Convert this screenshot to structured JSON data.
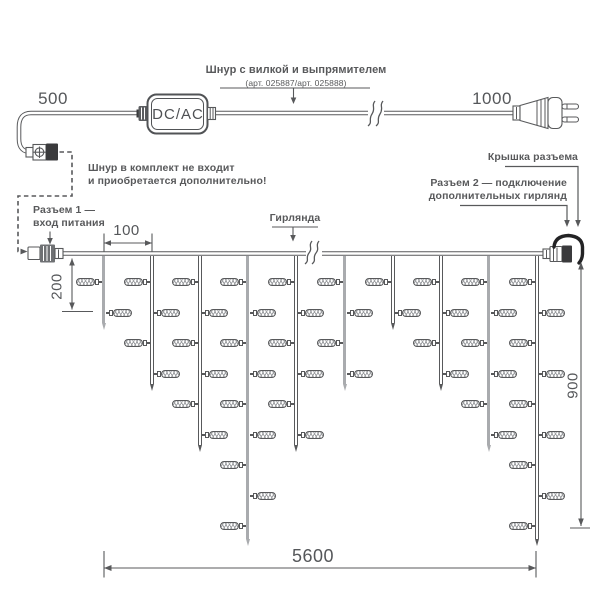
{
  "annotations": {
    "cord": {
      "title": "Шнур с вилкой и выпрямителем",
      "subtitle": "(арт. 025887/арт. 025888)"
    },
    "not_included": [
      "Шнур в комплект не входит",
      "и приобретается дополнительно!"
    ],
    "connector1": [
      "Разъем 1 —",
      "вход питания"
    ],
    "garland": "Гирлянда",
    "cap": "Крышка разъема",
    "connector2": [
      "Разъем 2 — подключение",
      "дополнительных гирлянд"
    ],
    "converter": "DC/AC"
  },
  "dimensions": {
    "cable_to_converter": "500",
    "cable_to_plug": "1000",
    "drop_spacing": "100",
    "first_drop_length": "200",
    "curtain_height": "900",
    "garland_length": "5600"
  },
  "colors": {
    "line": "#58595b",
    "text": "#55575a",
    "thick_drop": "#a9abae",
    "black_part": "#3a3a3c",
    "background": "#ffffff"
  },
  "garland": {
    "wire_y": 253.5,
    "drop_start_y": 256,
    "lamp_rows_y": [
      282,
      313,
      343,
      374,
      404,
      435,
      465,
      496,
      526
    ],
    "drops": [
      {
        "x": 104,
        "lamps": 2,
        "tip_y": 330,
        "thick": true
      },
      {
        "x": 152,
        "lamps": 4,
        "tip_y": 391,
        "thick": false
      },
      {
        "x": 200,
        "lamps": 6,
        "tip_y": 452,
        "thick": false
      },
      {
        "x": 248,
        "lamps": 9,
        "tip_y": 546,
        "thick": true
      },
      {
        "x": 296,
        "lamps": 6,
        "tip_y": 452,
        "thick": false
      },
      {
        "x": 345,
        "lamps": 4,
        "tip_y": 391,
        "thick": true
      },
      {
        "x": 393,
        "lamps": 2,
        "tip_y": 330,
        "thick": false
      },
      {
        "x": 441,
        "lamps": 4,
        "tip_y": 391,
        "thick": false
      },
      {
        "x": 489,
        "lamps": 6,
        "tip_y": 452,
        "thick": true
      },
      {
        "x": 537,
        "lamps": 9,
        "tip_y": 546,
        "thick": false
      }
    ]
  }
}
